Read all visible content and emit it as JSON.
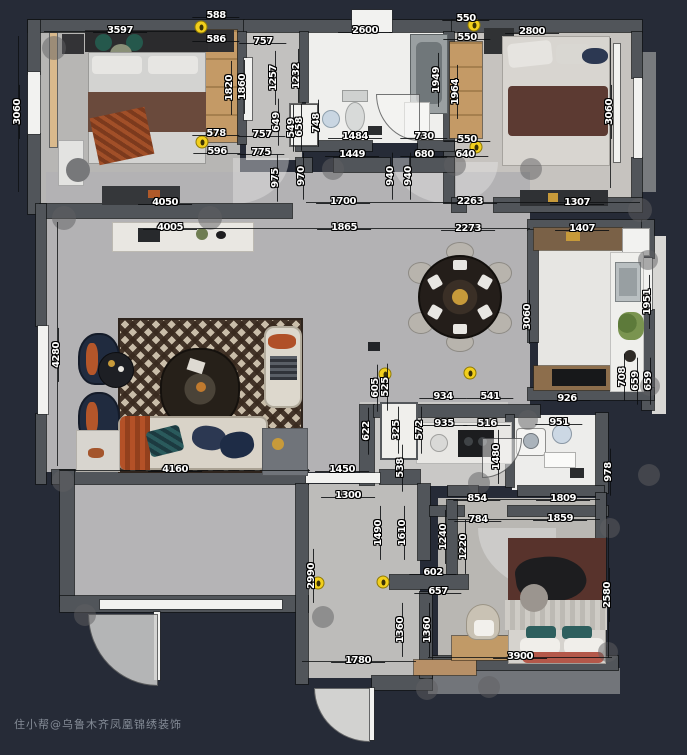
{
  "meta": {
    "watermark": "住小帮@乌鲁木齐凤凰锦绣装饰",
    "type_label": "apartment floor plan"
  },
  "colors": {
    "background": "#262b37",
    "wall": "#51555a",
    "floor_gray": "#b5b4b6",
    "floor_white": "#efefed",
    "wood": "#c19a67",
    "accent_yellow": "#f2cf1d",
    "accent_orange": "#b4562a",
    "navy": "#223050",
    "blanket_brown": "#5d3a33",
    "dim_text": "#ffffff"
  },
  "plan": {
    "dimensions": [
      {
        "t": "3597",
        "x": 120,
        "y": 31,
        "o": "h"
      },
      {
        "t": "588",
        "x": 216,
        "y": 16,
        "o": "h"
      },
      {
        "t": "586",
        "x": 216,
        "y": 40,
        "o": "h"
      },
      {
        "t": "757",
        "x": 263,
        "y": 42,
        "o": "h"
      },
      {
        "t": "2600",
        "x": 365,
        "y": 31,
        "o": "h"
      },
      {
        "t": "550",
        "x": 466,
        "y": 19,
        "o": "h"
      },
      {
        "t": "550",
        "x": 467,
        "y": 38,
        "o": "h"
      },
      {
        "t": "2800",
        "x": 532,
        "y": 32,
        "o": "h"
      },
      {
        "t": "3060",
        "x": 18,
        "y": 112,
        "o": "v"
      },
      {
        "t": "1257",
        "x": 274,
        "y": 78,
        "o": "v"
      },
      {
        "t": "1232",
        "x": 297,
        "y": 76,
        "o": "v"
      },
      {
        "t": "1820",
        "x": 230,
        "y": 88,
        "o": "v"
      },
      {
        "t": "1860",
        "x": 243,
        "y": 87,
        "o": "v"
      },
      {
        "t": "1949",
        "x": 437,
        "y": 80,
        "o": "v"
      },
      {
        "t": "1964",
        "x": 456,
        "y": 92,
        "o": "v"
      },
      {
        "t": "3060",
        "x": 610,
        "y": 112,
        "o": "v"
      },
      {
        "t": "578",
        "x": 216,
        "y": 134,
        "o": "h"
      },
      {
        "t": "757",
        "x": 262,
        "y": 135,
        "o": "h"
      },
      {
        "t": "596",
        "x": 217,
        "y": 152,
        "o": "h"
      },
      {
        "t": "775",
        "x": 261,
        "y": 153,
        "o": "h"
      },
      {
        "t": "649",
        "x": 277,
        "y": 122,
        "o": "v"
      },
      {
        "t": "549",
        "x": 292,
        "y": 128,
        "o": "v"
      },
      {
        "t": "658",
        "x": 300,
        "y": 127,
        "o": "v"
      },
      {
        "t": "748",
        "x": 317,
        "y": 123,
        "o": "v"
      },
      {
        "t": "1484",
        "x": 355,
        "y": 137,
        "o": "h"
      },
      {
        "t": "730",
        "x": 424,
        "y": 137,
        "o": "h"
      },
      {
        "t": "550",
        "x": 467,
        "y": 140,
        "o": "h"
      },
      {
        "t": "1449",
        "x": 352,
        "y": 155,
        "o": "h"
      },
      {
        "t": "680",
        "x": 424,
        "y": 155,
        "o": "h"
      },
      {
        "t": "640",
        "x": 465,
        "y": 155,
        "o": "h"
      },
      {
        "t": "975",
        "x": 276,
        "y": 178,
        "o": "v"
      },
      {
        "t": "970",
        "x": 302,
        "y": 176,
        "o": "v"
      },
      {
        "t": "940",
        "x": 391,
        "y": 176,
        "o": "v"
      },
      {
        "t": "940",
        "x": 409,
        "y": 176,
        "o": "v"
      },
      {
        "t": "4050",
        "x": 165,
        "y": 203,
        "o": "h"
      },
      {
        "t": "4005",
        "x": 170,
        "y": 228,
        "o": "h"
      },
      {
        "t": "1700",
        "x": 343,
        "y": 202,
        "o": "h"
      },
      {
        "t": "2263",
        "x": 470,
        "y": 202,
        "o": "h"
      },
      {
        "t": "1307",
        "x": 577,
        "y": 203,
        "o": "h"
      },
      {
        "t": "1865",
        "x": 344,
        "y": 228,
        "o": "h"
      },
      {
        "t": "2273",
        "x": 468,
        "y": 229,
        "o": "h"
      },
      {
        "t": "1407",
        "x": 582,
        "y": 229,
        "o": "h"
      },
      {
        "t": "3060",
        "x": 528,
        "y": 317,
        "o": "v"
      },
      {
        "t": "1951",
        "x": 648,
        "y": 302,
        "o": "v"
      },
      {
        "t": "4280",
        "x": 57,
        "y": 355,
        "o": "v"
      },
      {
        "t": "926",
        "x": 567,
        "y": 399,
        "o": "h"
      },
      {
        "t": "708",
        "x": 623,
        "y": 377,
        "o": "v"
      },
      {
        "t": "659",
        "x": 636,
        "y": 381,
        "o": "v"
      },
      {
        "t": "659",
        "x": 649,
        "y": 381,
        "o": "v"
      },
      {
        "t": "605",
        "x": 376,
        "y": 388,
        "o": "v"
      },
      {
        "t": "525",
        "x": 386,
        "y": 387,
        "o": "v"
      },
      {
        "t": "934",
        "x": 443,
        "y": 397,
        "o": "h"
      },
      {
        "t": "541",
        "x": 490,
        "y": 397,
        "o": "h"
      },
      {
        "t": "935",
        "x": 444,
        "y": 424,
        "o": "h"
      },
      {
        "t": "516",
        "x": 487,
        "y": 424,
        "o": "h"
      },
      {
        "t": "622",
        "x": 367,
        "y": 431,
        "o": "v"
      },
      {
        "t": "325",
        "x": 397,
        "y": 430,
        "o": "v"
      },
      {
        "t": "572",
        "x": 420,
        "y": 430,
        "o": "v"
      },
      {
        "t": "538",
        "x": 401,
        "y": 468,
        "o": "v"
      },
      {
        "t": "1480",
        "x": 497,
        "y": 457,
        "o": "v"
      },
      {
        "t": "4160",
        "x": 175,
        "y": 470,
        "o": "h"
      },
      {
        "t": "1450",
        "x": 342,
        "y": 470,
        "o": "h"
      },
      {
        "t": "1300",
        "x": 348,
        "y": 496,
        "o": "h"
      },
      {
        "t": "2990",
        "x": 312,
        "y": 576,
        "o": "v"
      },
      {
        "t": "1490",
        "x": 379,
        "y": 533,
        "o": "v"
      },
      {
        "t": "1610",
        "x": 403,
        "y": 533,
        "o": "v"
      },
      {
        "t": "602",
        "x": 433,
        "y": 573,
        "o": "h"
      },
      {
        "t": "657",
        "x": 438,
        "y": 592,
        "o": "h"
      },
      {
        "t": "1360",
        "x": 401,
        "y": 630,
        "o": "v"
      },
      {
        "t": "1360",
        "x": 428,
        "y": 630,
        "o": "v"
      },
      {
        "t": "1780",
        "x": 358,
        "y": 661,
        "o": "h"
      },
      {
        "t": "951",
        "x": 559,
        "y": 423,
        "o": "h"
      },
      {
        "t": "978",
        "x": 609,
        "y": 472,
        "o": "v"
      },
      {
        "t": "854",
        "x": 477,
        "y": 499,
        "o": "h"
      },
      {
        "t": "1809",
        "x": 563,
        "y": 499,
        "o": "h"
      },
      {
        "t": "784",
        "x": 478,
        "y": 520,
        "o": "h"
      },
      {
        "t": "1859",
        "x": 560,
        "y": 519,
        "o": "h"
      },
      {
        "t": "1240",
        "x": 444,
        "y": 537,
        "o": "v"
      },
      {
        "t": "1220",
        "x": 464,
        "y": 547,
        "o": "v"
      },
      {
        "t": "2580",
        "x": 608,
        "y": 595,
        "o": "v"
      },
      {
        "t": "3900",
        "x": 520,
        "y": 657,
        "o": "h"
      }
    ],
    "symbols": [
      {
        "x": 201,
        "y": 27
      },
      {
        "x": 202,
        "y": 142
      },
      {
        "x": 474,
        "y": 25
      },
      {
        "x": 476,
        "y": 147
      },
      {
        "x": 385,
        "y": 374
      },
      {
        "x": 470,
        "y": 373
      },
      {
        "x": 318,
        "y": 583
      },
      {
        "x": 383,
        "y": 582
      }
    ]
  }
}
